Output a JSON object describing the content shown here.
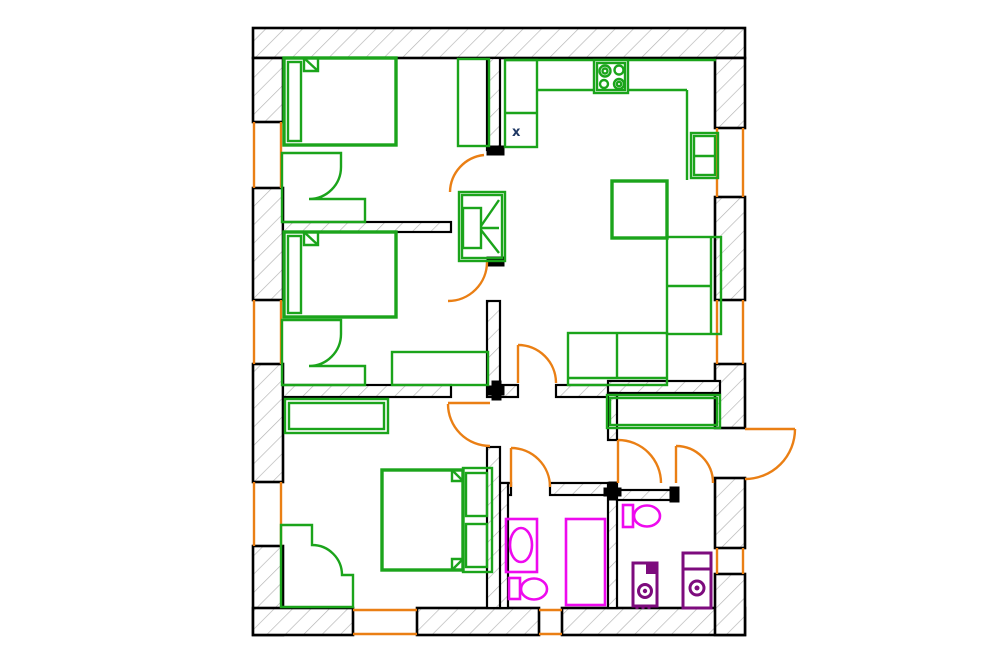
{
  "meta": {
    "type": "apartment-floor-plan",
    "marker_label": "x"
  },
  "palette": {
    "background": "#FFFFFF",
    "wall_border": "#000000",
    "hatch": "#B3B3B3",
    "furniture": "#1BA41B",
    "doors_windows": "#EA7F14",
    "sanitary": "#EE0AEE",
    "appliances": "#7D0B7D",
    "marker": "#1F3864"
  },
  "elements": [
    {
      "name": "exterior-walls",
      "cls": "wall",
      "shapes": [
        {
          "t": "rect",
          "x": 253,
          "y": 28,
          "w": 492,
          "h": 30
        },
        {
          "t": "rect",
          "x": 253,
          "y": 58,
          "w": 30,
          "h": 64
        },
        {
          "t": "rect",
          "x": 253,
          "y": 188,
          "w": 30,
          "h": 112
        },
        {
          "t": "rect",
          "x": 253,
          "y": 364,
          "w": 30,
          "h": 118
        },
        {
          "t": "rect",
          "x": 253,
          "y": 546,
          "w": 30,
          "h": 89
        },
        {
          "t": "rect",
          "x": 253,
          "y": 608,
          "w": 100,
          "h": 27
        },
        {
          "t": "rect",
          "x": 417,
          "y": 608,
          "w": 122,
          "h": 27
        },
        {
          "t": "rect",
          "x": 562,
          "y": 608,
          "w": 183,
          "h": 27
        },
        {
          "t": "rect",
          "x": 715,
          "y": 58,
          "w": 30,
          "h": 70
        },
        {
          "t": "rect",
          "x": 715,
          "y": 197,
          "w": 30,
          "h": 103
        },
        {
          "t": "rect",
          "x": 715,
          "y": 364,
          "w": 30,
          "h": 64
        },
        {
          "t": "rect",
          "x": 715,
          "y": 478,
          "w": 30,
          "h": 70
        },
        {
          "t": "rect",
          "x": 715,
          "y": 574,
          "w": 30,
          "h": 61
        }
      ]
    },
    {
      "name": "interior-walls",
      "cls": "iw",
      "shapes": [
        {
          "t": "rect",
          "x": 283,
          "y": 222,
          "w": 168,
          "h": 10
        },
        {
          "t": "rect",
          "x": 283,
          "y": 385,
          "w": 168,
          "h": 12
        },
        {
          "t": "rect",
          "x": 500,
          "y": 385,
          "w": 18,
          "h": 12
        },
        {
          "t": "rect",
          "x": 556,
          "y": 385,
          "w": 61,
          "h": 12
        },
        {
          "t": "rect",
          "x": 608,
          "y": 381,
          "w": 112,
          "h": 12
        },
        {
          "t": "rect",
          "x": 608,
          "y": 393,
          "w": 9,
          "h": 47
        },
        {
          "t": "rect",
          "x": 608,
          "y": 483,
          "w": 9,
          "h": 125
        },
        {
          "t": "rect",
          "x": 497,
          "y": 483,
          "w": 14,
          "h": 12
        },
        {
          "t": "rect",
          "x": 550,
          "y": 483,
          "w": 58,
          "h": 12
        },
        {
          "t": "rect",
          "x": 497,
          "y": 483,
          "w": 11,
          "h": 125
        },
        {
          "t": "rect",
          "x": 487,
          "y": 447,
          "w": 13,
          "h": 161
        },
        {
          "t": "rect",
          "x": 617,
          "y": 490,
          "w": 55,
          "h": 10
        },
        {
          "t": "rect",
          "x": 487,
          "y": 58,
          "w": 13,
          "h": 92
        },
        {
          "t": "rect",
          "x": 487,
          "y": 301,
          "w": 13,
          "h": 96
        }
      ]
    },
    {
      "name": "wall-end-caps",
      "cls": "solidk",
      "shapes": [
        {
          "t": "rect",
          "x": 487,
          "y": 146,
          "w": 17,
          "h": 9
        },
        {
          "t": "rect",
          "x": 487,
          "y": 257,
          "w": 17,
          "h": 9
        },
        {
          "t": "rect",
          "x": 488,
          "y": 386,
          "w": 16,
          "h": 9
        },
        {
          "t": "rect",
          "x": 492,
          "y": 381,
          "w": 9,
          "h": 19
        },
        {
          "t": "rect",
          "x": 604,
          "y": 488,
          "w": 17,
          "h": 8
        },
        {
          "t": "rect",
          "x": 609,
          "y": 482,
          "w": 8,
          "h": 18
        },
        {
          "t": "rect",
          "x": 670,
          "y": 487,
          "w": 9,
          "h": 15
        }
      ]
    },
    {
      "name": "windows",
      "cls": "win",
      "shapes": [
        {
          "t": "line",
          "x1": 254,
          "y1": 122,
          "x2": 254,
          "y2": 188
        },
        {
          "t": "line",
          "x1": 281,
          "y1": 122,
          "x2": 281,
          "y2": 188
        },
        {
          "t": "line",
          "x1": 254,
          "y1": 300,
          "x2": 254,
          "y2": 364
        },
        {
          "t": "line",
          "x1": 281,
          "y1": 300,
          "x2": 281,
          "y2": 364
        },
        {
          "t": "line",
          "x1": 254,
          "y1": 482,
          "x2": 254,
          "y2": 546
        },
        {
          "t": "line",
          "x1": 281,
          "y1": 482,
          "x2": 281,
          "y2": 546
        },
        {
          "t": "line",
          "x1": 717,
          "y1": 128,
          "x2": 717,
          "y2": 197
        },
        {
          "t": "line",
          "x1": 743,
          "y1": 128,
          "x2": 743,
          "y2": 197
        },
        {
          "t": "line",
          "x1": 717,
          "y1": 300,
          "x2": 717,
          "y2": 364
        },
        {
          "t": "line",
          "x1": 743,
          "y1": 300,
          "x2": 743,
          "y2": 364
        },
        {
          "t": "line",
          "x1": 717,
          "y1": 548,
          "x2": 717,
          "y2": 574
        },
        {
          "t": "line",
          "x1": 743,
          "y1": 548,
          "x2": 743,
          "y2": 574
        },
        {
          "t": "line",
          "x1": 353,
          "y1": 610,
          "x2": 417,
          "y2": 610
        },
        {
          "t": "line",
          "x1": 353,
          "y1": 634,
          "x2": 417,
          "y2": 634
        },
        {
          "t": "line",
          "x1": 539,
          "y1": 610,
          "x2": 562,
          "y2": 610
        },
        {
          "t": "line",
          "x1": 539,
          "y1": 634,
          "x2": 562,
          "y2": 634
        }
      ]
    },
    {
      "name": "doors",
      "cls": "door",
      "shapes": [
        {
          "t": "path",
          "d": "M 450 192 A 38 38 0 0 1 484 155"
        },
        {
          "t": "path",
          "d": "M 487 262 A 39 39 0 0 1 448 301"
        },
        {
          "t": "path",
          "d": "M 448 404 A 42 42 0 0 0 490 446"
        },
        {
          "t": "line",
          "x1": 448,
          "y1": 403,
          "x2": 490,
          "y2": 403
        },
        {
          "t": "path",
          "d": "M 518 345 A 38 38 0 0 1 556 383"
        },
        {
          "t": "line",
          "x1": 518,
          "y1": 345,
          "x2": 518,
          "y2": 383
        },
        {
          "t": "path",
          "d": "M 511 448 A 39 39 0 0 1 550 487"
        },
        {
          "t": "line",
          "x1": 511,
          "y1": 448,
          "x2": 511,
          "y2": 487
        },
        {
          "t": "path",
          "d": "M 618 440 A 43 43 0 0 1 661 483"
        },
        {
          "t": "line",
          "x1": 618,
          "y1": 440,
          "x2": 618,
          "y2": 483
        },
        {
          "t": "path",
          "d": "M 676 446 A 37 37 0 0 1 713 483"
        },
        {
          "t": "line",
          "x1": 676,
          "y1": 446,
          "x2": 676,
          "y2": 483
        },
        {
          "t": "path",
          "d": "M 795 429 A 50 50 0 0 1 745 479"
        },
        {
          "t": "line",
          "x1": 745,
          "y1": 429,
          "x2": 795,
          "y2": 429
        }
      ]
    },
    {
      "name": "bedroom1-bed",
      "cls": "furn",
      "shapes": [
        {
          "t": "rect",
          "x": 284,
          "y": 58,
          "w": 112,
          "h": 87,
          "c": "furn3"
        },
        {
          "t": "rect",
          "x": 288,
          "y": 62,
          "w": 13,
          "h": 79
        },
        {
          "t": "polyline",
          "pts": "304,58 304,71 318,71 318,58"
        },
        {
          "t": "line",
          "x1": 304,
          "y1": 58,
          "x2": 318,
          "y2": 71
        }
      ]
    },
    {
      "name": "bedroom1-desk",
      "cls": "furn",
      "shapes": [
        {
          "t": "path",
          "d": "M282 153 L341 153 L341 167 A32 32 0 0 1 309 199 L365 199 L365 222 L282 222 Z"
        }
      ]
    },
    {
      "name": "bedroom1-wardrobe",
      "cls": "furn",
      "shapes": [
        {
          "t": "rect",
          "x": 458,
          "y": 59,
          "w": 31,
          "h": 87
        }
      ]
    },
    {
      "name": "bedroom2-bed",
      "cls": "furn",
      "shapes": [
        {
          "t": "rect",
          "x": 284,
          "y": 232,
          "w": 112,
          "h": 85,
          "c": "furn3"
        },
        {
          "t": "rect",
          "x": 288,
          "y": 236,
          "w": 13,
          "h": 77
        },
        {
          "t": "polyline",
          "pts": "304,232 304,245 318,245 318,232"
        },
        {
          "t": "line",
          "x1": 304,
          "y1": 232,
          "x2": 318,
          "y2": 245
        }
      ]
    },
    {
      "name": "bedroom2-desk",
      "cls": "furn",
      "shapes": [
        {
          "t": "path",
          "d": "M282 320 L341 320 L341 334 A32 32 0 0 1 309 366 L365 366 L365 385 L282 385 Z"
        }
      ]
    },
    {
      "name": "bedroom2-cabinet",
      "cls": "furn",
      "shapes": [
        {
          "t": "rect",
          "x": 392,
          "y": 352,
          "w": 96,
          "h": 33
        }
      ]
    },
    {
      "name": "bedroom3-cabinet",
      "cls": "furn",
      "shapes": [
        {
          "t": "rect",
          "x": 285,
          "y": 399,
          "w": 103,
          "h": 34
        },
        {
          "t": "rect",
          "x": 289,
          "y": 403,
          "w": 95,
          "h": 26
        }
      ]
    },
    {
      "name": "bedroom3-double-bed",
      "cls": "furn",
      "shapes": [
        {
          "t": "rect",
          "x": 382,
          "y": 470,
          "w": 81,
          "h": 100,
          "c": "furn3"
        },
        {
          "t": "rect",
          "x": 463,
          "y": 468,
          "w": 29,
          "h": 104
        },
        {
          "t": "rect",
          "x": 466,
          "y": 473,
          "w": 21,
          "h": 43
        },
        {
          "t": "rect",
          "x": 466,
          "y": 524,
          "w": 21,
          "h": 43
        },
        {
          "t": "polyline",
          "pts": "452,470 452,481 463,481"
        },
        {
          "t": "line",
          "x1": 452,
          "y1": 470,
          "x2": 463,
          "y2": 481
        },
        {
          "t": "polyline",
          "pts": "452,570 452,559 463,559"
        },
        {
          "t": "line",
          "x1": 452,
          "y1": 570,
          "x2": 463,
          "y2": 559
        }
      ]
    },
    {
      "name": "bedroom3-desk",
      "cls": "furn",
      "shapes": [
        {
          "t": "path",
          "d": "M281 525 L312 525 L312 545 A30 30 0 0 1 342 575 L353 575 L353 607 L281 607 Z"
        }
      ]
    },
    {
      "name": "kitchen-counter",
      "cls": "furn",
      "shapes": [
        {
          "t": "line",
          "x1": 506,
          "y1": 60,
          "x2": 716,
          "y2": 60
        },
        {
          "t": "line",
          "x1": 537,
          "y1": 90,
          "x2": 687,
          "y2": 90
        },
        {
          "t": "line",
          "x1": 687,
          "y1": 90,
          "x2": 687,
          "y2": 180
        },
        {
          "t": "rect",
          "x": 505,
          "y": 60,
          "w": 32,
          "h": 87
        },
        {
          "t": "line",
          "x1": 505,
          "y1": 113,
          "x2": 537,
          "y2": 113
        }
      ]
    },
    {
      "name": "kitchen-stove",
      "cls": "furn",
      "shapes": [
        {
          "t": "rect",
          "x": 594,
          "y": 60,
          "w": 34,
          "h": 33,
          "c": "furnw"
        },
        {
          "t": "rect",
          "x": 597,
          "y": 63,
          "w": 28,
          "h": 27
        },
        {
          "t": "circle",
          "cx": 605,
          "cy": 71,
          "r": 5.5
        },
        {
          "t": "circle",
          "cx": 605,
          "cy": 71,
          "r": 2.5
        },
        {
          "t": "circle",
          "cx": 619,
          "cy": 70,
          "r": 4.5
        },
        {
          "t": "circle",
          "cx": 604,
          "cy": 84,
          "r": 4
        },
        {
          "t": "circle",
          "cx": 619,
          "cy": 84,
          "r": 5
        },
        {
          "t": "circle",
          "cx": 619,
          "cy": 84,
          "r": 2.2
        }
      ]
    },
    {
      "name": "kitchen-fridge",
      "cls": "furn",
      "shapes": [
        {
          "t": "rect",
          "x": 691,
          "y": 133,
          "w": 27,
          "h": 45
        },
        {
          "t": "rect",
          "x": 694,
          "y": 136,
          "w": 21,
          "h": 39
        },
        {
          "t": "line",
          "x1": 694,
          "y1": 156,
          "x2": 715,
          "y2": 156
        }
      ]
    },
    {
      "name": "dining-table",
      "cls": "furn",
      "shapes": [
        {
          "t": "rect",
          "x": 612,
          "y": 181,
          "w": 55,
          "h": 57,
          "c": "furn3"
        }
      ]
    },
    {
      "name": "living-sofa",
      "cls": "furn",
      "shapes": [
        {
          "t": "rect",
          "x": 667,
          "y": 237,
          "w": 54,
          "h": 97
        },
        {
          "t": "line",
          "x1": 711,
          "y1": 237,
          "x2": 711,
          "y2": 334
        },
        {
          "t": "line",
          "x1": 667,
          "y1": 286,
          "x2": 711,
          "y2": 286
        },
        {
          "t": "rect",
          "x": 568,
          "y": 333,
          "w": 99,
          "h": 52
        },
        {
          "t": "line",
          "x1": 568,
          "y1": 378,
          "x2": 667,
          "y2": 378
        },
        {
          "t": "line",
          "x1": 617,
          "y1": 333,
          "x2": 617,
          "y2": 378
        }
      ]
    },
    {
      "name": "hallway-cabinet",
      "cls": "furn",
      "shapes": [
        {
          "t": "rect",
          "x": 607,
          "y": 395,
          "w": 113,
          "h": 33
        },
        {
          "t": "rect",
          "x": 610,
          "y": 398,
          "w": 107,
          "h": 27
        }
      ]
    },
    {
      "name": "tv-unit",
      "cls": "furn",
      "shapes": [
        {
          "t": "rect",
          "x": 459,
          "y": 192,
          "w": 46,
          "h": 69
        },
        {
          "t": "rect",
          "x": 462,
          "y": 195,
          "w": 40,
          "h": 63
        },
        {
          "t": "rect",
          "x": 463,
          "y": 208,
          "w": 18,
          "h": 40
        },
        {
          "t": "line",
          "x1": 499,
          "y1": 200,
          "x2": 481,
          "y2": 226
        },
        {
          "t": "line",
          "x1": 499,
          "y1": 253,
          "x2": 481,
          "y2": 230
        },
        {
          "t": "line",
          "x1": 481,
          "y1": 228,
          "x2": 499,
          "y2": 228
        }
      ]
    },
    {
      "name": "bathroom1-sink",
      "cls": "san",
      "shapes": [
        {
          "t": "rect",
          "x": 506,
          "y": 519,
          "w": 31,
          "h": 53
        },
        {
          "t": "ellipse",
          "cx": 521,
          "cy": 545,
          "rx": 11,
          "ry": 17
        }
      ]
    },
    {
      "name": "bathroom1-toilet",
      "cls": "san",
      "shapes": [
        {
          "t": "rect",
          "x": 509,
          "y": 578,
          "w": 11,
          "h": 21
        },
        {
          "t": "ellipse",
          "cx": 534,
          "cy": 589,
          "rx": 13,
          "ry": 10.5
        }
      ]
    },
    {
      "name": "bathroom1-bathtub",
      "cls": "san",
      "shapes": [
        {
          "t": "rect",
          "x": 566,
          "y": 519,
          "w": 39,
          "h": 86
        }
      ]
    },
    {
      "name": "bathroom2-toilet",
      "cls": "san",
      "shapes": [
        {
          "t": "rect",
          "x": 623,
          "y": 505,
          "w": 10,
          "h": 22
        },
        {
          "t": "ellipse",
          "cx": 647,
          "cy": 516,
          "rx": 13,
          "ry": 10.5
        }
      ]
    },
    {
      "name": "bathroom2-boiler",
      "cls": "app",
      "shapes": [
        {
          "t": "rect",
          "x": 633,
          "y": 563,
          "w": 24,
          "h": 43
        },
        {
          "t": "rect",
          "x": 646,
          "y": 563,
          "w": 11,
          "h": 11,
          "c": "appf"
        },
        {
          "t": "circle",
          "cx": 645,
          "cy": 591,
          "r": 6.5
        },
        {
          "t": "circle",
          "cx": 645,
          "cy": 591,
          "r": 2.2,
          "c": "appf"
        },
        {
          "t": "line",
          "x1": 637,
          "y1": 606,
          "x2": 637,
          "y2": 609
        },
        {
          "t": "line",
          "x1": 643,
          "y1": 606,
          "x2": 643,
          "y2": 609
        },
        {
          "t": "line",
          "x1": 649,
          "y1": 606,
          "x2": 649,
          "y2": 609
        }
      ]
    },
    {
      "name": "bathroom2-washing-machine",
      "cls": "app",
      "shapes": [
        {
          "t": "rect",
          "x": 683,
          "y": 553,
          "w": 28,
          "h": 55
        },
        {
          "t": "line",
          "x1": 683,
          "y1": 569,
          "x2": 711,
          "y2": 569
        },
        {
          "t": "circle",
          "cx": 697,
          "cy": 588,
          "r": 7
        },
        {
          "t": "circle",
          "cx": 697,
          "cy": 588,
          "r": 2.5,
          "c": "appf"
        }
      ]
    },
    {
      "name": "kitchen-x-marker",
      "cls": "marker",
      "shapes": [
        {
          "t": "text",
          "x": 512,
          "y": 136,
          "s": "x"
        }
      ]
    }
  ]
}
